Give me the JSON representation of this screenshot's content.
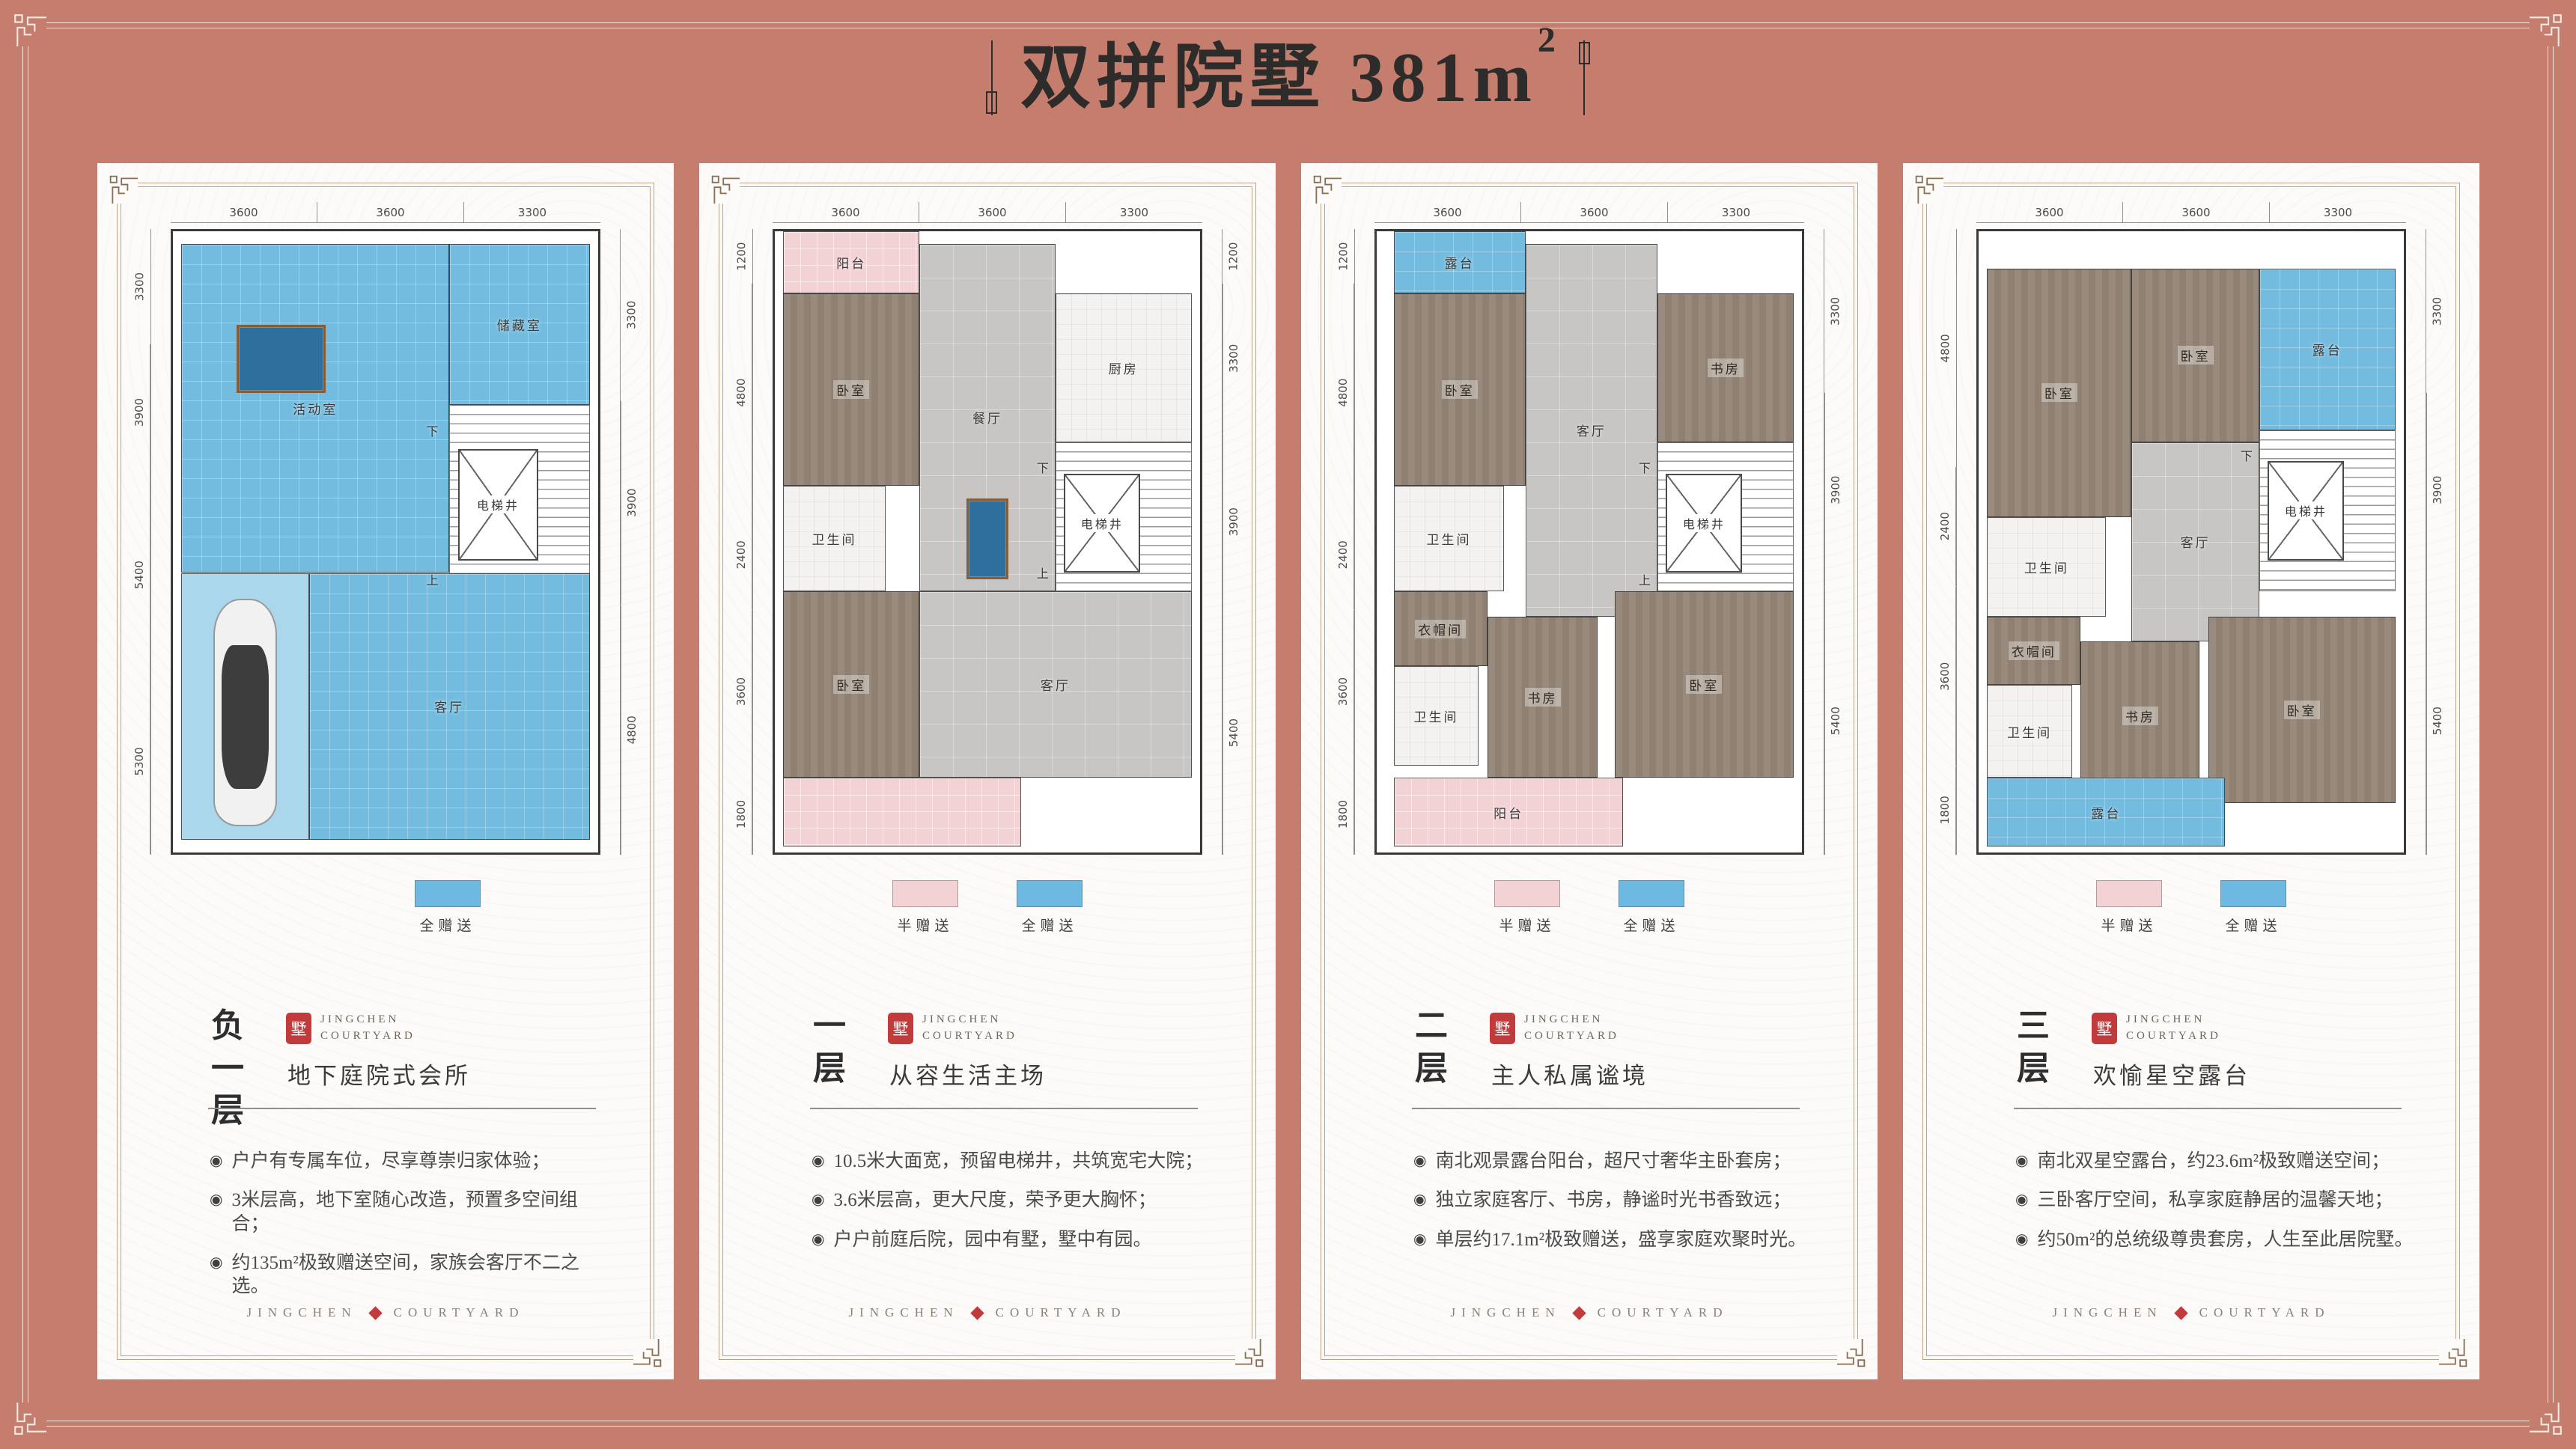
{
  "page": {
    "title": "双拼院墅 381m",
    "title_sup": "2"
  },
  "colors": {
    "bg": "#c57d6e",
    "blue": "#74bcdf",
    "pink": "#f3d2d6",
    "seal": "#c23b3c"
  },
  "bullet_glyph": "◉",
  "legend_labels": {
    "half": "半赠送",
    "full": "全赠送"
  },
  "brand": {
    "seal_char": "墅",
    "name_line1": "JINGCHEN",
    "name_line2": "COURTYARD",
    "footer_left": "JINGCHEN",
    "footer_right": "COURTYARD"
  },
  "panels": [
    {
      "floor_name": "负一层",
      "subtitle": "地下庭院式会所",
      "bullets": [
        "户户有专属车位，尽享尊崇归家体验；",
        "3米层高，地下室随心改造，预置多空间组合；",
        "约135m²极致赠送空间，家族会客厅不二之选。"
      ],
      "legend": [
        "full"
      ],
      "dims_top": [
        "3600",
        "3600",
        "3300"
      ],
      "dims_left": [
        "3300",
        "3900",
        "5400",
        "5300"
      ],
      "dims_right": [
        "3300",
        "3900",
        "4800"
      ],
      "rooms": [
        {
          "type": "blue",
          "label": "活动室",
          "x": 2,
          "y": 2,
          "w": 63,
          "h": 53
        },
        {
          "type": "blue",
          "label": "储藏室",
          "x": 65,
          "y": 2,
          "w": 33,
          "h": 26
        },
        {
          "type": "stairs",
          "label": "",
          "x": 65,
          "y": 28,
          "w": 33,
          "h": 33
        },
        {
          "type": "elevator",
          "label": "电梯井",
          "x": 67,
          "y": 35,
          "w": 19,
          "h": 18
        },
        {
          "type": "pool",
          "label": "",
          "x": 15,
          "y": 15,
          "w": 21,
          "h": 11
        },
        {
          "type": "blue_light",
          "label": "",
          "x": 2,
          "y": 55,
          "w": 30,
          "h": 43
        },
        {
          "type": "car",
          "label": "",
          "x": 6,
          "y": 58,
          "w": 22,
          "h": 39
        },
        {
          "type": "blue",
          "label": "客厅",
          "x": 32,
          "y": 55,
          "w": 66,
          "h": 43
        },
        {
          "type": "text",
          "label": "下",
          "x": 57,
          "y": 29,
          "w": 8,
          "h": 6
        },
        {
          "type": "text",
          "label": "上",
          "x": 57,
          "y": 53,
          "w": 8,
          "h": 6
        }
      ]
    },
    {
      "floor_name": "一层",
      "subtitle": "从容生活主场",
      "bullets": [
        "10.5米大面宽，预留电梯井，共筑宽宅大院；",
        "3.6米层高，更大尺度，荣予更大胸怀；",
        "户户前庭后院，园中有墅，墅中有园。"
      ],
      "legend": [
        "half",
        "full"
      ],
      "dims_top": [
        "3600",
        "3600",
        "3300"
      ],
      "dims_left": [
        "1200",
        "4800",
        "2400",
        "3600",
        "1800"
      ],
      "dims_right": [
        "1200",
        "3300",
        "3900",
        "5400"
      ],
      "rooms": [
        {
          "type": "pink",
          "label": "阳台",
          "x": 2,
          "y": 0,
          "w": 32,
          "h": 10
        },
        {
          "type": "wood",
          "label": "卧室",
          "x": 2,
          "y": 10,
          "w": 32,
          "h": 31
        },
        {
          "type": "gray",
          "label": "餐厅",
          "x": 34,
          "y": 2,
          "w": 32,
          "h": 56
        },
        {
          "type": "white",
          "label": "厨房",
          "x": 66,
          "y": 10,
          "w": 32,
          "h": 24
        },
        {
          "type": "stairs",
          "label": "",
          "x": 66,
          "y": 34,
          "w": 32,
          "h": 24
        },
        {
          "type": "elevator",
          "label": "电梯井",
          "x": 68,
          "y": 39,
          "w": 18,
          "h": 16
        },
        {
          "type": "white",
          "label": "卫生间",
          "x": 2,
          "y": 41,
          "w": 24,
          "h": 17
        },
        {
          "type": "wood",
          "label": "卧室",
          "x": 2,
          "y": 58,
          "w": 32,
          "h": 30
        },
        {
          "type": "gray",
          "label": "客厅",
          "x": 34,
          "y": 58,
          "w": 64,
          "h": 30
        },
        {
          "type": "pool",
          "label": "",
          "x": 45,
          "y": 43,
          "w": 10,
          "h": 13
        },
        {
          "type": "pink",
          "label": "",
          "x": 2,
          "y": 88,
          "w": 56,
          "h": 11
        },
        {
          "type": "text",
          "label": "下",
          "x": 59,
          "y": 35,
          "w": 8,
          "h": 6
        },
        {
          "type": "text",
          "label": "上",
          "x": 59,
          "y": 52,
          "w": 8,
          "h": 6
        }
      ]
    },
    {
      "floor_name": "二层",
      "subtitle": "主人私属谧境",
      "bullets": [
        "南北观景露台阳台，超尺寸奢华主卧套房；",
        "独立家庭客厅、书房，静谧时光书香致远；",
        "单层约17.1m²极致赠送，盛享家庭欢聚时光。"
      ],
      "legend": [
        "half",
        "full"
      ],
      "dims_top": [
        "3600",
        "3600",
        "3300"
      ],
      "dims_left": [
        "1200",
        "4800",
        "2400",
        "3600",
        "1800"
      ],
      "dims_right": [
        "3300",
        "3900",
        "5400"
      ],
      "rooms": [
        {
          "type": "blue",
          "label": "露台",
          "x": 4,
          "y": 0,
          "w": 31,
          "h": 10
        },
        {
          "type": "wood",
          "label": "卧室",
          "x": 4,
          "y": 10,
          "w": 31,
          "h": 31
        },
        {
          "type": "gray",
          "label": "客厅",
          "x": 35,
          "y": 2,
          "w": 31,
          "h": 60
        },
        {
          "type": "wood",
          "label": "书房",
          "x": 66,
          "y": 10,
          "w": 32,
          "h": 24
        },
        {
          "type": "stairs",
          "label": "",
          "x": 66,
          "y": 34,
          "w": 32,
          "h": 24
        },
        {
          "type": "elevator",
          "label": "电梯井",
          "x": 68,
          "y": 39,
          "w": 18,
          "h": 16
        },
        {
          "type": "white",
          "label": "卫生间",
          "x": 4,
          "y": 41,
          "w": 26,
          "h": 17
        },
        {
          "type": "wood",
          "label": "衣帽间",
          "x": 4,
          "y": 58,
          "w": 22,
          "h": 12
        },
        {
          "type": "white",
          "label": "卫生间",
          "x": 4,
          "y": 70,
          "w": 20,
          "h": 16
        },
        {
          "type": "wood",
          "label": "书房",
          "x": 26,
          "y": 62,
          "w": 26,
          "h": 26
        },
        {
          "type": "wood",
          "label": "卧室",
          "x": 56,
          "y": 58,
          "w": 42,
          "h": 30
        },
        {
          "type": "pink",
          "label": "阳台",
          "x": 4,
          "y": 88,
          "w": 54,
          "h": 11
        },
        {
          "type": "text",
          "label": "下",
          "x": 59,
          "y": 35,
          "w": 8,
          "h": 6
        },
        {
          "type": "text",
          "label": "上",
          "x": 59,
          "y": 53,
          "w": 8,
          "h": 6
        }
      ]
    },
    {
      "floor_name": "三层",
      "subtitle": "欢愉星空露台",
      "bullets": [
        "南北双星空露台，约23.6m²极致赠送空间；",
        "三卧客厅空间，私享家庭静居的温馨天地；",
        "约50m²的总统级尊贵套房，人生至此居院墅。"
      ],
      "legend": [
        "half",
        "full"
      ],
      "dims_top": [
        "3600",
        "3600",
        "3300"
      ],
      "dims_left": [
        "4800",
        "2400",
        "3600",
        "1800"
      ],
      "dims_right": [
        "3300",
        "3900",
        "5400"
      ],
      "rooms": [
        {
          "type": "wood",
          "label": "卧室",
          "x": 2,
          "y": 6,
          "w": 34,
          "h": 40
        },
        {
          "type": "wood",
          "label": "卧室",
          "x": 36,
          "y": 6,
          "w": 30,
          "h": 28
        },
        {
          "type": "blue",
          "label": "露台",
          "x": 66,
          "y": 6,
          "w": 32,
          "h": 26
        },
        {
          "type": "gray",
          "label": "客厅",
          "x": 36,
          "y": 34,
          "w": 30,
          "h": 32
        },
        {
          "type": "stairs",
          "label": "",
          "x": 66,
          "y": 32,
          "w": 32,
          "h": 26
        },
        {
          "type": "elevator",
          "label": "电梯井",
          "x": 68,
          "y": 37,
          "w": 18,
          "h": 16
        },
        {
          "type": "white",
          "label": "卫生间",
          "x": 2,
          "y": 46,
          "w": 28,
          "h": 16
        },
        {
          "type": "wood",
          "label": "衣帽间",
          "x": 2,
          "y": 62,
          "w": 22,
          "h": 11
        },
        {
          "type": "white",
          "label": "卫生间",
          "x": 2,
          "y": 73,
          "w": 20,
          "h": 15
        },
        {
          "type": "wood",
          "label": "书房",
          "x": 24,
          "y": 66,
          "w": 28,
          "h": 24
        },
        {
          "type": "wood",
          "label": "卧室",
          "x": 54,
          "y": 62,
          "w": 44,
          "h": 30
        },
        {
          "type": "blue",
          "label": "露台",
          "x": 2,
          "y": 88,
          "w": 56,
          "h": 11
        },
        {
          "type": "text",
          "label": "下",
          "x": 59,
          "y": 33,
          "w": 8,
          "h": 6
        }
      ]
    }
  ]
}
